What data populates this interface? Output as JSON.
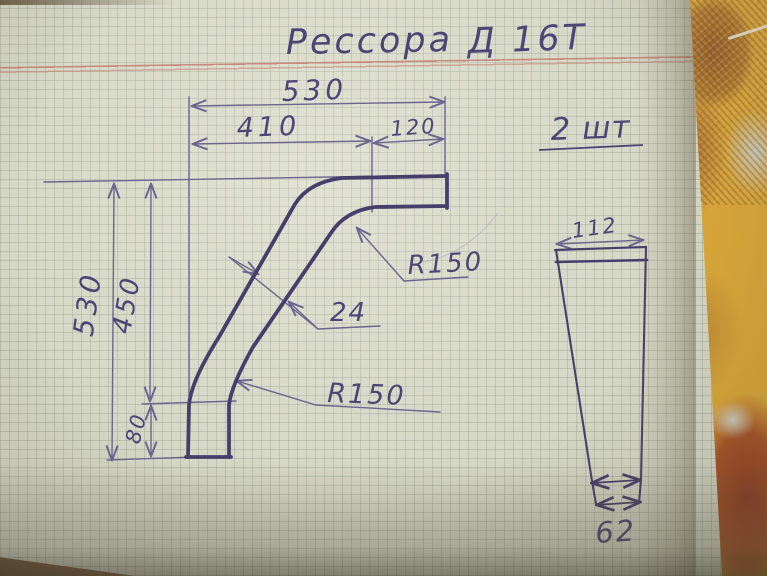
{
  "title": {
    "part1": "Рессора",
    "part2": "Д 16Т"
  },
  "quantity_note": "2 шт",
  "main_view": {
    "width_total": "530",
    "width_upper": "410",
    "width_end": "120",
    "height_total": "530",
    "height_inner": "450",
    "height_foot": "80",
    "thickness": "24",
    "radius_upper": "R150",
    "radius_lower": "R150"
  },
  "side_view": {
    "width_top": "112",
    "width_bottom": "62"
  },
  "colors": {
    "ink": "#473f6b",
    "pencil": "#6c6590",
    "paper": "#d5d7c5",
    "margin_line": "#c67c70",
    "cloth_yellow": "#ddaa3b",
    "cloth_dark_center": "#8f3c20"
  }
}
